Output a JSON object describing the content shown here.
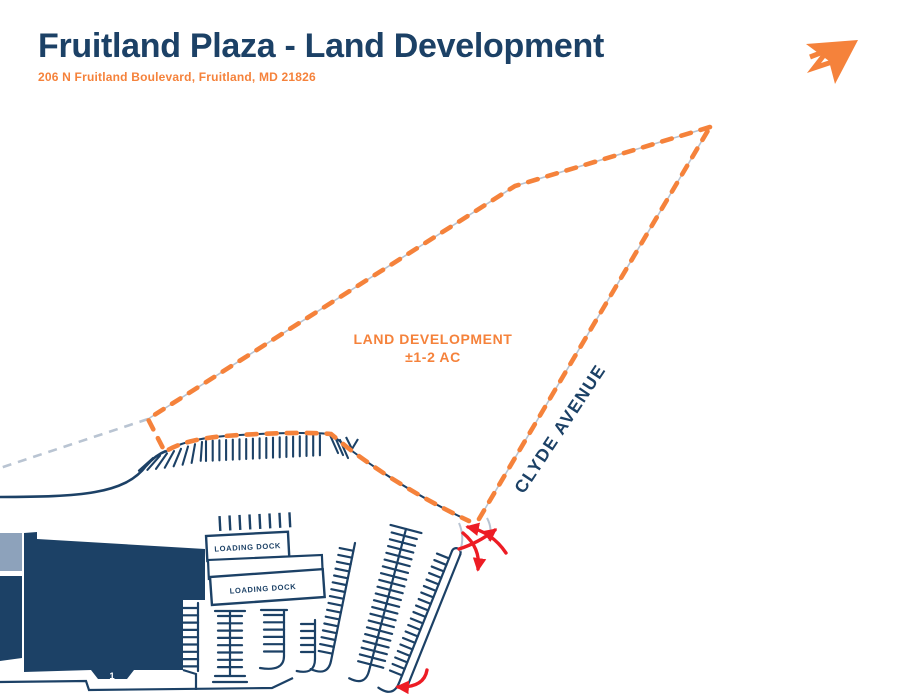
{
  "header": {
    "title": "Fruitland Plaza - Land Development",
    "subtitle": "206 N Fruitland Boulevard, Fruitland, MD 21826"
  },
  "logo": {
    "icon": "send-arrow-logo"
  },
  "plan": {
    "parcel_label_line1": "LAND DEVELOPMENT",
    "parcel_label_line2": "±1-2 AC",
    "street_label": "CLYDE AVENUE",
    "loading_dock_label_1": "LOADING DOCK",
    "loading_dock_label_2": "LOADING DOCK",
    "building_number": "1"
  },
  "colors": {
    "navy": "#1c4166",
    "orange": "#f5823b",
    "red": "#ed1c24",
    "parcel_line_gray": "#b9c4d2",
    "annex_gray": "#8da2bb"
  }
}
